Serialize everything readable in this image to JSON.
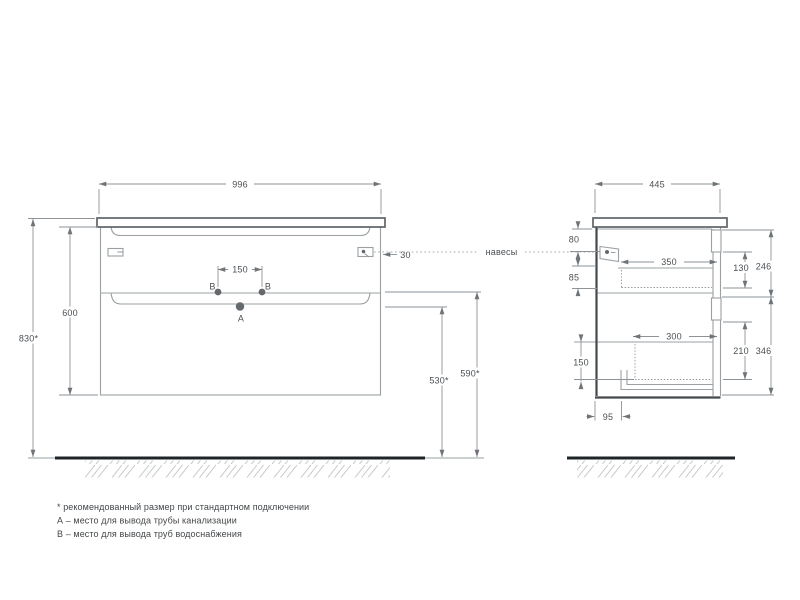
{
  "front_view": {
    "dims": {
      "width": "996",
      "cabinet_height": "600",
      "total_height": "830*",
      "supply_holes_spacing": "150",
      "hanger_edge_offset": "30",
      "drain_outlet_height": "530*",
      "supply_outlet_height": "590*"
    },
    "points": {
      "a": "А",
      "b_left": "В",
      "b_right": "В"
    }
  },
  "side_view": {
    "dims": {
      "depth": "445",
      "hanger_top_offset": "80",
      "hanger_drawer_gap": "85",
      "top_drawer_depth": "350",
      "top_drawer_inner_height": "130",
      "top_section_height": "246",
      "bottom_drawer_depth": "300",
      "bottom_drawer_inner_height": "210",
      "bottom_section_height": "346",
      "bottom_drawer_box_height": "150",
      "drain_back_offset": "95"
    }
  },
  "callouts": {
    "hangers": "навесы"
  },
  "notes": {
    "asterisk": "* рекомендованный размер при стандартном подключении",
    "point_a": "А – место для вывода трубы канализации",
    "point_b": "В – место для вывода труб водоснабжения"
  },
  "colors": {
    "line": "#9aa0a3",
    "dark_edge": "#44494d",
    "floor": "#1f2427",
    "text": "#4b5054",
    "background": "#ffffff"
  }
}
